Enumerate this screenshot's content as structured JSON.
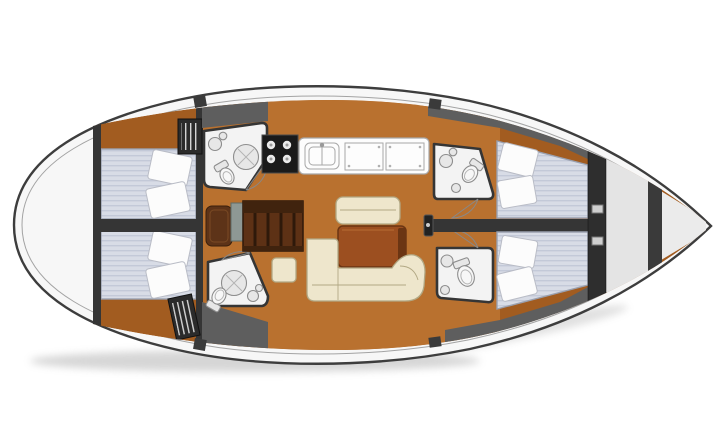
{
  "meta": {
    "width": 720,
    "height": 446,
    "orientation": "bow-right"
  },
  "colors": {
    "background": "#ffffff",
    "hull_fill": "#f7f7f7",
    "hull_stroke": "#3d3d3d",
    "deck_line": "#a3a3a3",
    "wall_dark": "#353535",
    "deck_gray": "#5e5e5e",
    "wood_floor": "#b9712f",
    "wood_dark": "#a25c20",
    "table_wood": "#9c4f20",
    "table_edge": "#6b3513",
    "settee_cream": "#eee6cc",
    "settee_stroke": "#b2a884",
    "mattress": "#d8dce6",
    "mattress_stripe": "#c3c9d8",
    "mattress_stroke": "#9aa0af",
    "pillow": "#fcfcfc",
    "pillow_stroke": "#b9bcc6",
    "bath_floor": "#f3f3f3",
    "fixture_fill": "#e7e7e7",
    "fixture_stroke": "#8d8d8d",
    "stove_black": "#1a1a1a",
    "burner": "#eaeaea",
    "counter_white": "#fdfdfd",
    "counter_stroke": "#a8a8a8",
    "nav_table": "#5d3115",
    "nav_seat": "#5d3318",
    "nav_panel": "#8e9894",
    "louver_dark": "#2b2b2b",
    "louver_slat": "#d4d4d4",
    "bow_locker": "#ebebeb",
    "door_arc": "#888888"
  },
  "plan": {
    "type": "deck-plan",
    "vessel": "monohull-sailing-yacht",
    "cabins": [
      {
        "id": "aft-cabin-port",
        "berth": "double"
      },
      {
        "id": "aft-cabin-starboard",
        "berth": "double"
      },
      {
        "id": "forward-cabin-port",
        "berth": "double"
      },
      {
        "id": "forward-cabin-starboard",
        "berth": "double"
      }
    ],
    "heads": [
      {
        "id": "head-aft-port",
        "fixtures": [
          "toilet",
          "sink",
          "shower"
        ]
      },
      {
        "id": "head-aft-starboard",
        "fixtures": [
          "toilet",
          "sink",
          "shower"
        ]
      },
      {
        "id": "head-forward-port",
        "fixtures": [
          "toilet",
          "sink"
        ]
      },
      {
        "id": "head-forward-starboard",
        "fixtures": [
          "toilet",
          "sink"
        ]
      }
    ],
    "common_areas": [
      {
        "id": "salon",
        "furniture": [
          "l-shaped-settee",
          "bench-settee",
          "table",
          "stool"
        ]
      },
      {
        "id": "galley",
        "equipment": [
          "stove-4-burner",
          "double-sink",
          "counter-lids"
        ]
      },
      {
        "id": "nav-station",
        "furniture": [
          "chart-table",
          "seat"
        ]
      },
      {
        "id": "bow-sail-locker"
      },
      {
        "id": "stern-lazarette"
      }
    ]
  }
}
